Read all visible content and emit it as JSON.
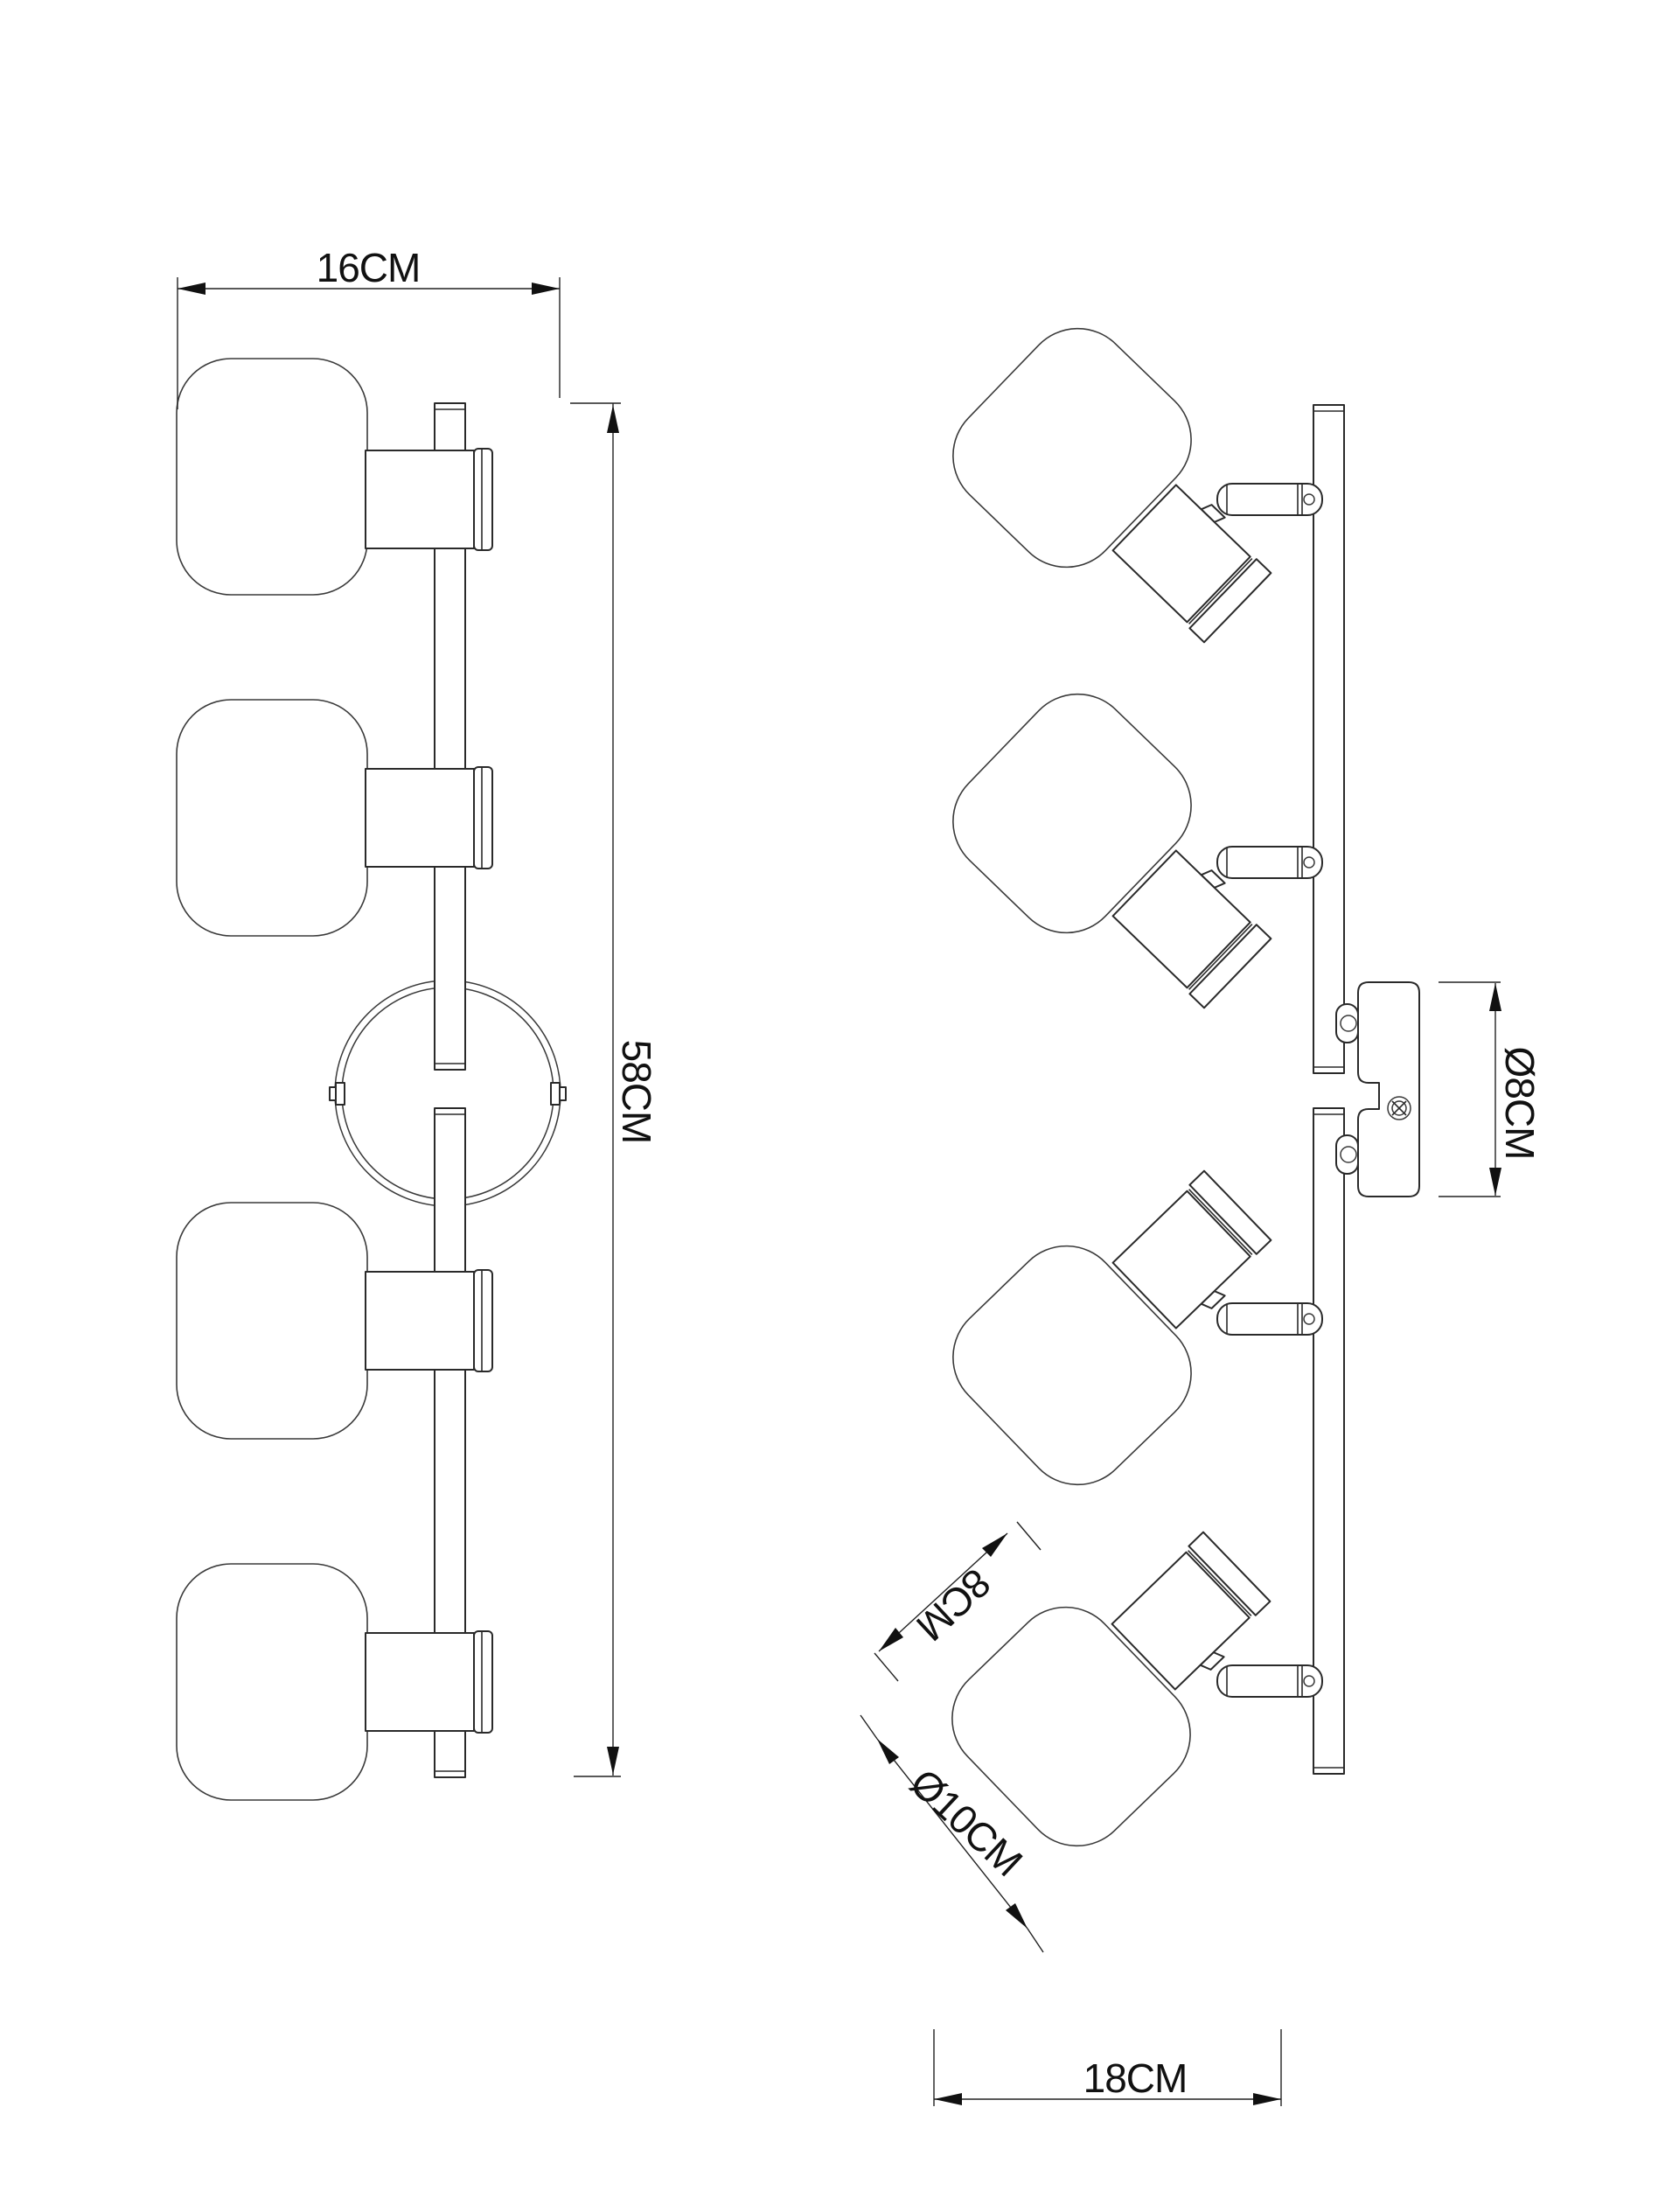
{
  "drawing": {
    "background_color": "#ffffff",
    "line_color": "#2a2a2a",
    "dimension_color": "#111111",
    "views": {
      "front": {
        "dimensions": {
          "width": {
            "label": "16CM"
          },
          "height": {
            "label": "58CM"
          }
        }
      },
      "side": {
        "dimensions": {
          "canopy_diameter": {
            "label": "Ø8CM"
          },
          "spot_body_length": {
            "label": "8CM"
          },
          "shade_diameter": {
            "label": "Ø10CM"
          },
          "depth": {
            "label": "18CM"
          }
        }
      }
    }
  }
}
